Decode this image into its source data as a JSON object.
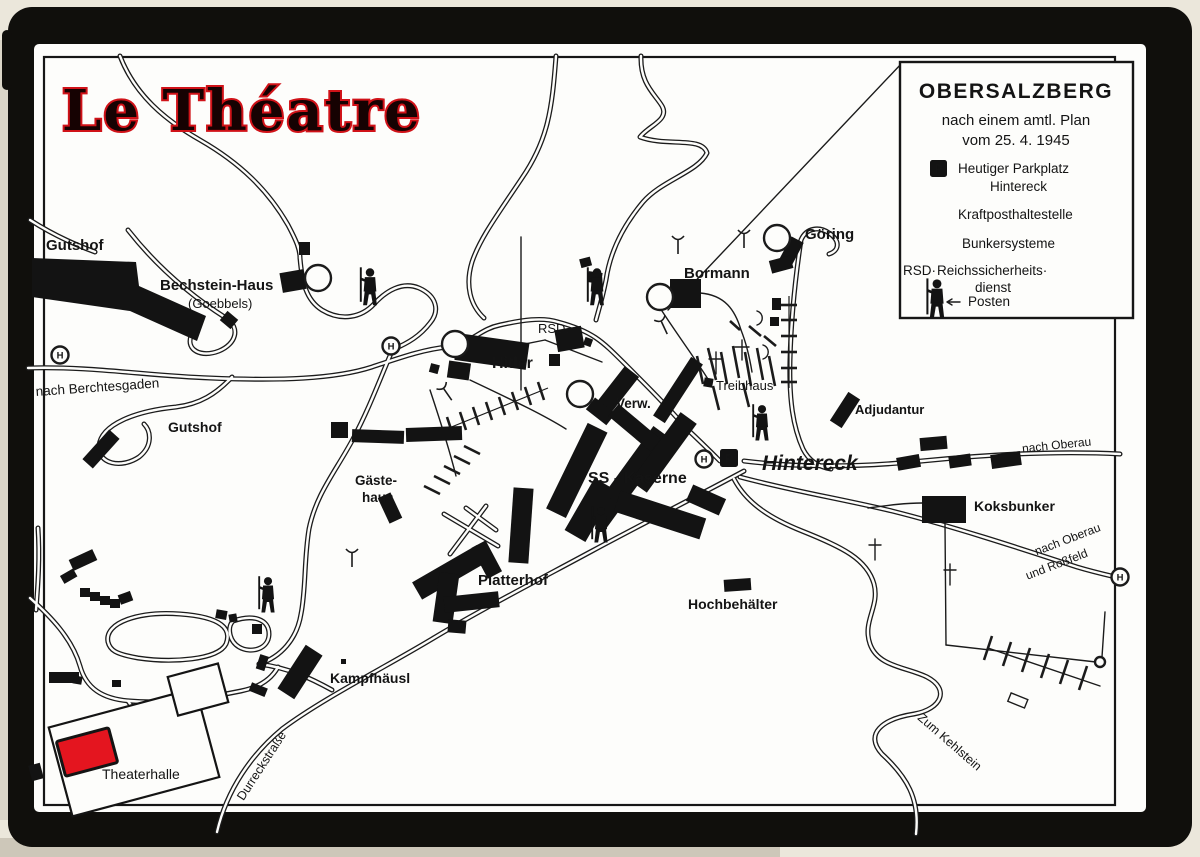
{
  "title": "Le Théatre",
  "legend": {
    "heading": "OBERSALZBERG",
    "subtitle1": "nach einem amtl. Plan",
    "subtitle2": "vom 25. 4. 1945",
    "items": [
      {
        "symbol": "parking-square",
        "label1": "Heutiger Parkplatz",
        "label2": "Hintereck"
      },
      {
        "symbol": "bus-stop-circle",
        "label1": "Kraftposthaltestelle"
      },
      {
        "symbol": "bunker-symbol",
        "label1": "Bunkersysteme"
      },
      {
        "symbol": "rsd-abbreviation",
        "prefix": "RSD·",
        "label1": "Reichssicherheits·",
        "label2": "dienst"
      },
      {
        "symbol": "sentry-figure",
        "label1": "Posten"
      }
    ]
  },
  "markers": {
    "p": "P",
    "h": "H"
  },
  "labels": {
    "gutshof_nw": "Gutshof",
    "bechstein": "Bechstein-Haus",
    "goebbels": "(Goebbels)",
    "nach_berchtesgaden": "nach Berchtesgaden",
    "gutshof_w": "Gutshof",
    "rsd": "RSD.",
    "hitler": "Hitler",
    "verw": "Verw.",
    "bormann": "Bormann",
    "goering": "Göring",
    "treibhaus": "Treibhaus",
    "adjudantur": "Adjudantur",
    "gaeste_line1": "Gäste-",
    "gaeste_line2": "haus",
    "ss_kaserne": "SS - Kaserne",
    "hintereck": "Hintereck",
    "nach_oberau_e": "nach Oberau",
    "koksbunker": "Koksbunker",
    "nach_oberau_se1": "nach Oberau",
    "nach_oberau_se2": "und Roßfeld",
    "platterhof": "Platterhof",
    "hochbehaelter": "Hochbehälter",
    "kampfhaeusl": "Kampfhäusl",
    "theaterhalle": "Theaterhalle",
    "durreckstrasse": "Durreckstraße",
    "zum_kehlstein": "Zum Kehlstein"
  },
  "colors": {
    "accent_red": "#e4151f",
    "title_glow": "#d01218",
    "ink": "#1b1b1b",
    "paper": "#fdfdfb",
    "frame": "#100f0c",
    "mat": "#ebe7db"
  }
}
